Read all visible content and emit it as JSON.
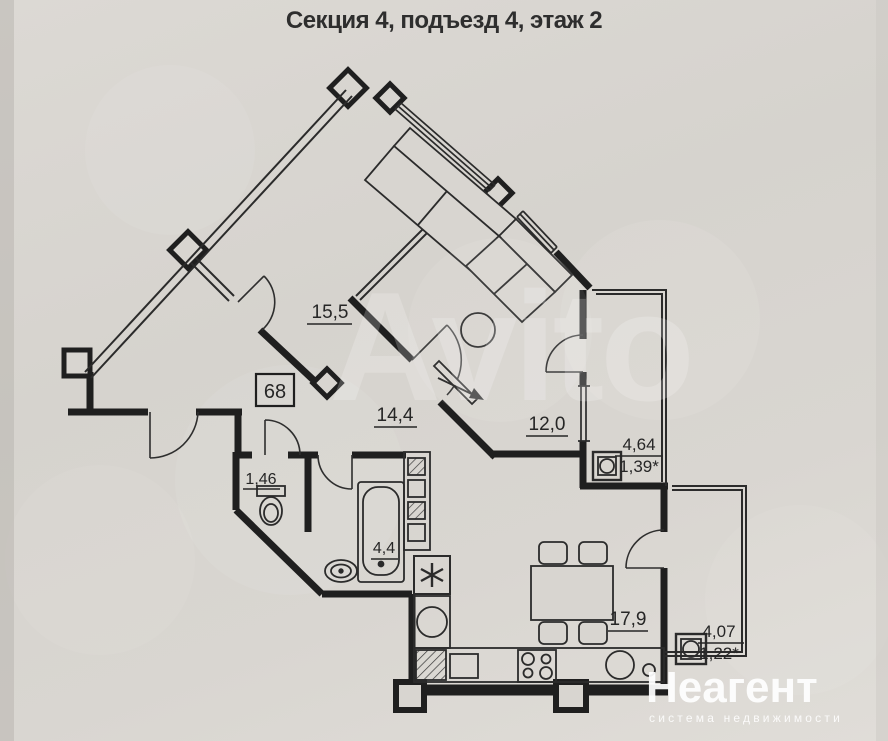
{
  "title": "Секция 4, подъезд 4, этаж 2",
  "apartment": {
    "number": "68"
  },
  "rooms": [
    {
      "name": "room-top",
      "label": "15,5"
    },
    {
      "name": "hallway",
      "label": "14,4"
    },
    {
      "name": "living-room",
      "label": "12,0"
    },
    {
      "name": "wc",
      "label": "1,46"
    },
    {
      "name": "bathroom",
      "label": "4,4"
    },
    {
      "name": "kitchen",
      "label": "17,9"
    }
  ],
  "loggias": [
    {
      "name": "loggia-right",
      "area": "4,64",
      "area_reduced": "1,39*"
    },
    {
      "name": "loggia-bottom",
      "area": "4,07",
      "area_reduced": "1,22*"
    }
  ],
  "symbols": {
    "kitchen_marker": "asterisk"
  },
  "watermark": {
    "text": "Avito"
  },
  "branding": {
    "name": "Неагент",
    "tagline": "система недвижимости"
  },
  "colors": {
    "paper": "#d8d5d0",
    "ink": "#222222",
    "watermark": "#ffffff"
  }
}
